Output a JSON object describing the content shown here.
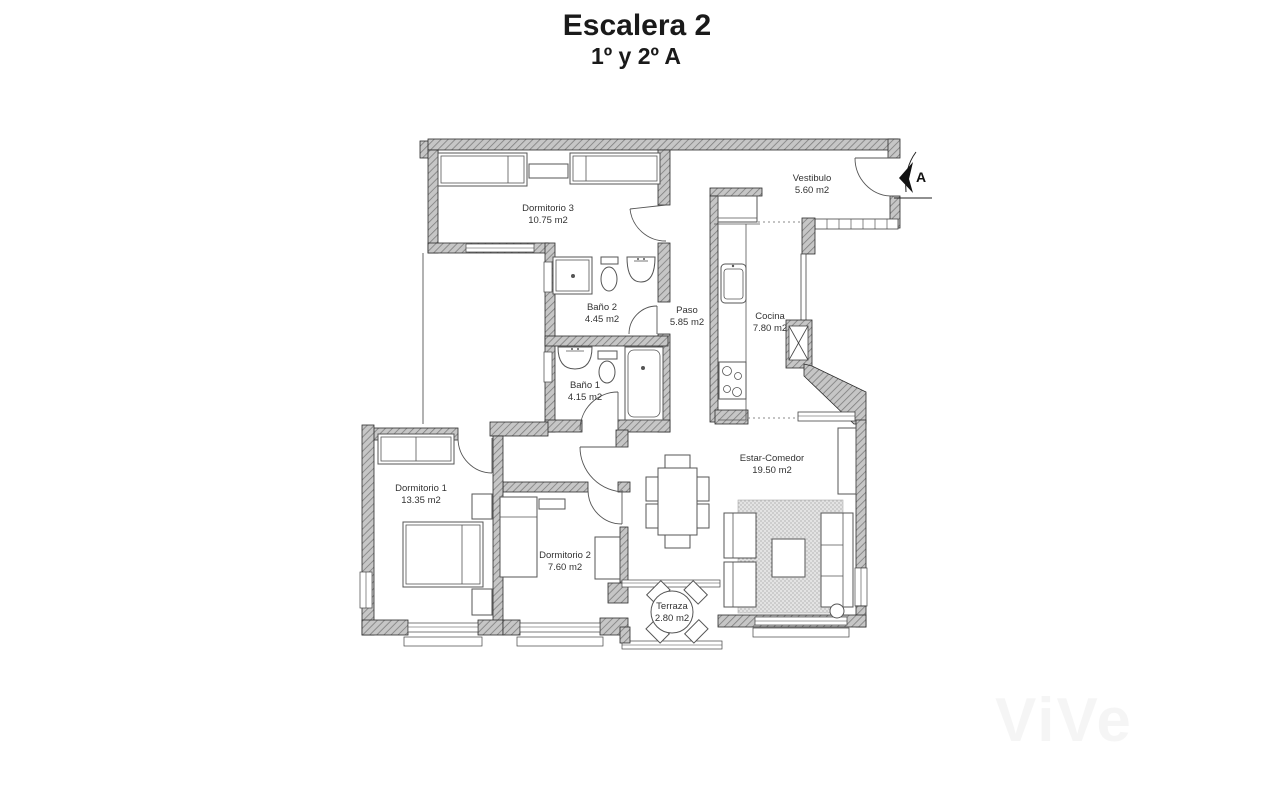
{
  "title": "Escalera 2",
  "subtitle": "1º y 2º A",
  "section_marker": "A",
  "watermark": "ViVe",
  "rooms": {
    "dormitorio3": {
      "name": "Dormitorio 3",
      "area": "10.75 m2"
    },
    "vestibulo": {
      "name": "Vestibulo",
      "area": "5.60 m2"
    },
    "bano2": {
      "name": "Baño 2",
      "area": "4.45 m2"
    },
    "paso": {
      "name": "Paso",
      "area": "5.85 m2"
    },
    "cocina": {
      "name": "Cocina",
      "area": "7.80 m2"
    },
    "bano1": {
      "name": "Baño 1",
      "area": "4.15 m2"
    },
    "dormitorio1": {
      "name": "Dormitorio 1",
      "area": "13.35 m2"
    },
    "dormitorio2": {
      "name": "Dormitorio 2",
      "area": "7.60 m2"
    },
    "estar": {
      "name": "Estar-Comedor",
      "area": "19.50 m2"
    },
    "terraza": {
      "name": "Terraza",
      "area": "2.80 m2"
    }
  }
}
